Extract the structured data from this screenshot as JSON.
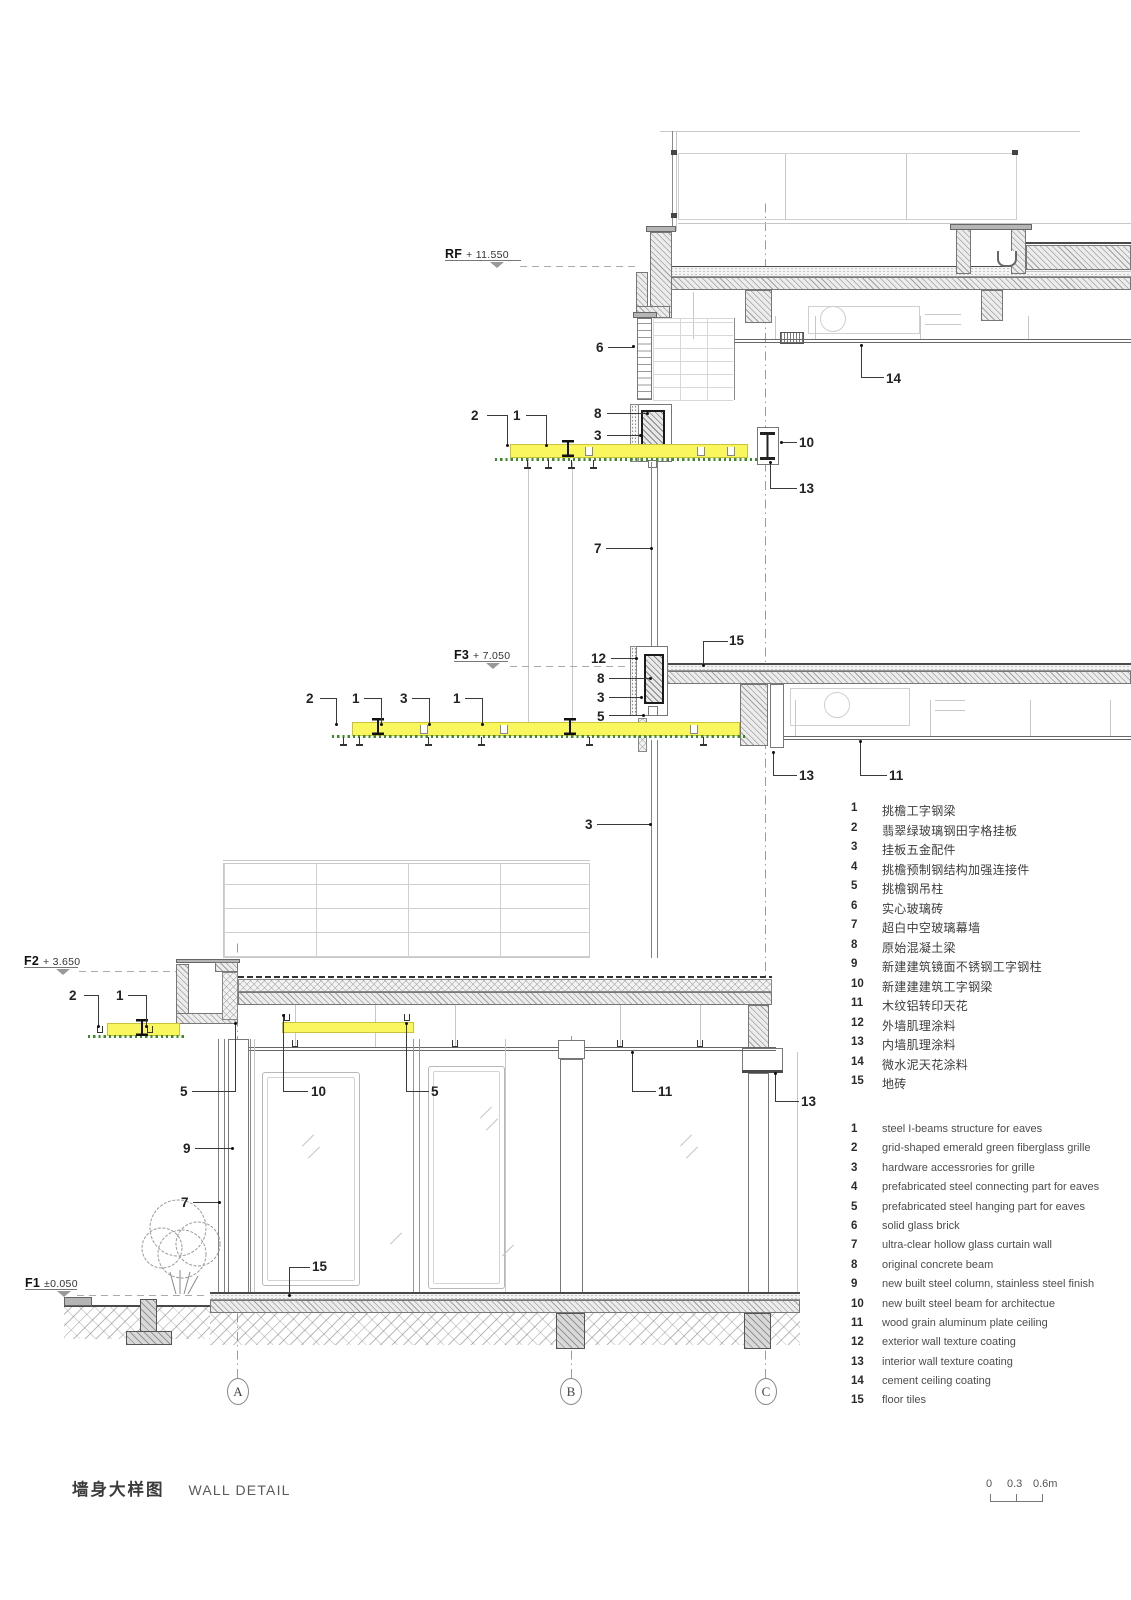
{
  "title": {
    "zh": "墙身大样图",
    "en": "WALL DETAIL"
  },
  "scale_bar": {
    "labels": [
      "0",
      "0.3",
      "0.6m"
    ]
  },
  "grid_axes": [
    "A",
    "B",
    "C"
  ],
  "levels": [
    {
      "label": "RF",
      "value": "+ 11.550"
    },
    {
      "label": "F3",
      "value": "+ 7.050"
    },
    {
      "label": "F2",
      "value": "+ 3.650"
    },
    {
      "label": "F1",
      "value": "±0.050"
    }
  ],
  "colors": {
    "eave_highlight": "#faf75e",
    "grille_green": "#3f8a28"
  },
  "legend_zh": {
    "items": [
      {
        "no": "1",
        "text": "挑檐工字钢梁"
      },
      {
        "no": "2",
        "text": "翡翠绿玻璃钢田字格挂板"
      },
      {
        "no": "3",
        "text": "挂板五金配件"
      },
      {
        "no": "4",
        "text": "挑檐预制钢结构加强连接件"
      },
      {
        "no": "5",
        "text": "挑檐钢吊柱"
      },
      {
        "no": "6",
        "text": "实心玻璃砖"
      },
      {
        "no": "7",
        "text": "超白中空玻璃幕墙"
      },
      {
        "no": "8",
        "text": "原始混凝土梁"
      },
      {
        "no": "9",
        "text": "新建建筑镜面不锈钢工字钢柱"
      },
      {
        "no": "10",
        "text": "新建建建筑工字钢梁"
      },
      {
        "no": "11",
        "text": "木纹铝转印天花"
      },
      {
        "no": "12",
        "text": "外墙肌理涂料"
      },
      {
        "no": "13",
        "text": "内墙肌理涂料"
      },
      {
        "no": "14",
        "text": "微水泥天花涂料"
      },
      {
        "no": "15",
        "text": "地砖"
      }
    ]
  },
  "legend_en": {
    "items": [
      {
        "no": "1",
        "text": "steel I-beams structure for eaves"
      },
      {
        "no": "2",
        "text": "grid-shaped emerald green fiberglass grille"
      },
      {
        "no": "3",
        "text": "hardware accessrories for grille"
      },
      {
        "no": "4",
        "text": "prefabricated steel connecting part for eaves"
      },
      {
        "no": "5",
        "text": "prefabricated steel hanging part for eaves"
      },
      {
        "no": "6",
        "text": "solid glass brick"
      },
      {
        "no": "7",
        "text": "ultra-clear hollow glass curtain wall"
      },
      {
        "no": "8",
        "text": "original concrete beam"
      },
      {
        "no": "9",
        "text": "new built steel column, stainless steel finish"
      },
      {
        "no": "10",
        "text": "new built steel beam for architectue"
      },
      {
        "no": "11",
        "text": "wood grain aluminum plate ceiling"
      },
      {
        "no": "12",
        "text": "exterior wall texture coating"
      },
      {
        "no": "13",
        "text": "interior wall texture coating"
      },
      {
        "no": "14",
        "text": "cement ceiling coating"
      },
      {
        "no": "15",
        "text": "floor tiles"
      }
    ]
  },
  "callouts": [
    {
      "label": "6",
      "x": 596,
      "y": 340,
      "segs": [
        [
          608,
          347,
          26,
          1
        ]
      ],
      "dot": [
        632,
        345
      ]
    },
    {
      "label": "14",
      "x": 886,
      "y": 371,
      "segs": [
        [
          861,
          345,
          1,
          33
        ],
        [
          862,
          377,
          22,
          1
        ]
      ],
      "dot": [
        860,
        344
      ]
    },
    {
      "label": "2",
      "x": 471,
      "y": 408,
      "segs": [
        [
          487,
          415,
          21,
          1
        ],
        [
          507,
          415,
          1,
          31
        ]
      ],
      "dot": [
        506,
        444
      ]
    },
    {
      "label": "1",
      "x": 513,
      "y": 408,
      "segs": [
        [
          526,
          415,
          21,
          1
        ],
        [
          546,
          415,
          1,
          31
        ]
      ],
      "dot": [
        545,
        444
      ]
    },
    {
      "label": "8",
      "x": 594,
      "y": 406,
      "segs": [
        [
          607,
          413,
          40,
          1
        ]
      ],
      "dot": [
        646,
        412
      ]
    },
    {
      "label": "3",
      "x": 594,
      "y": 428,
      "segs": [
        [
          607,
          435,
          33,
          1
        ]
      ],
      "dot": [
        639,
        434
      ]
    },
    {
      "label": "10",
      "x": 799,
      "y": 435,
      "segs": [
        [
          781,
          442,
          16,
          1
        ]
      ],
      "dot": [
        780,
        441
      ]
    },
    {
      "label": "13",
      "x": 799,
      "y": 481,
      "segs": [
        [
          770,
          462,
          1,
          27
        ],
        [
          770,
          488,
          27,
          1
        ]
      ],
      "dot": [
        769,
        461
      ]
    },
    {
      "label": "7",
      "x": 594,
      "y": 541,
      "segs": [
        [
          606,
          548,
          45,
          1
        ]
      ],
      "dot": [
        650,
        547
      ]
    },
    {
      "label": "15",
      "x": 729,
      "y": 633,
      "segs": [
        [
          703,
          641,
          25,
          1
        ],
        [
          703,
          641,
          1,
          25
        ]
      ],
      "dot": [
        702,
        664
      ]
    },
    {
      "label": "12",
      "x": 591,
      "y": 651,
      "segs": [
        [
          611,
          658,
          25,
          1
        ]
      ],
      "dot": [
        635,
        657
      ]
    },
    {
      "label": "8",
      "x": 597,
      "y": 671,
      "segs": [
        [
          609,
          678,
          41,
          1
        ]
      ],
      "dot": [
        649,
        677
      ]
    },
    {
      "label": "3",
      "x": 597,
      "y": 690,
      "segs": [
        [
          609,
          697,
          32,
          1
        ]
      ],
      "dot": [
        640,
        696
      ]
    },
    {
      "label": "5",
      "x": 597,
      "y": 709,
      "segs": [
        [
          609,
          715,
          34,
          1
        ]
      ],
      "dot": [
        642,
        714
      ]
    },
    {
      "label": "2",
      "x": 306,
      "y": 691,
      "segs": [
        [
          320,
          698,
          17,
          1
        ],
        [
          336,
          698,
          1,
          27
        ]
      ],
      "dot": [
        335,
        723
      ]
    },
    {
      "label": "1",
      "x": 352,
      "y": 691,
      "segs": [
        [
          364,
          698,
          18,
          1
        ],
        [
          381,
          698,
          1,
          27
        ]
      ],
      "dot": [
        380,
        723
      ]
    },
    {
      "label": "3",
      "x": 400,
      "y": 691,
      "segs": [
        [
          412,
          698,
          18,
          1
        ],
        [
          429,
          698,
          1,
          27
        ]
      ],
      "dot": [
        428,
        723
      ]
    },
    {
      "label": "1",
      "x": 453,
      "y": 691,
      "segs": [
        [
          465,
          698,
          18,
          1
        ],
        [
          482,
          698,
          1,
          27
        ]
      ],
      "dot": [
        481,
        723
      ]
    },
    {
      "label": "13",
      "x": 799,
      "y": 768,
      "segs": [
        [
          773,
          752,
          1,
          24
        ],
        [
          773,
          775,
          24,
          1
        ]
      ],
      "dot": [
        772,
        751
      ]
    },
    {
      "label": "11",
      "x": 889,
      "y": 768,
      "segs": [
        [
          860,
          741,
          1,
          35
        ],
        [
          860,
          775,
          27,
          1
        ]
      ],
      "dot": [
        859,
        740
      ]
    },
    {
      "label": "3",
      "x": 585,
      "y": 817,
      "segs": [
        [
          597,
          824,
          53,
          1
        ]
      ],
      "dot": [
        649,
        823
      ]
    },
    {
      "label": "2",
      "x": 69,
      "y": 988,
      "segs": [
        [
          84,
          995,
          15,
          1
        ],
        [
          98,
          995,
          1,
          31
        ]
      ],
      "dot": [
        97,
        1025
      ]
    },
    {
      "label": "1",
      "x": 116,
      "y": 988,
      "segs": [
        [
          128,
          995,
          19,
          1
        ],
        [
          146,
          995,
          1,
          31
        ]
      ],
      "dot": [
        145,
        1025
      ]
    },
    {
      "label": "5",
      "x": 180,
      "y": 1084,
      "segs": [
        [
          192,
          1091,
          44,
          1
        ],
        [
          235,
          1024,
          1,
          68
        ]
      ],
      "dot": [
        234,
        1022
      ]
    },
    {
      "label": "10",
      "x": 311,
      "y": 1084,
      "segs": [
        [
          283,
          1091,
          25,
          1
        ],
        [
          283,
          1016,
          1,
          76
        ]
      ],
      "dot": [
        282,
        1014
      ]
    },
    {
      "label": "5",
      "x": 431,
      "y": 1084,
      "segs": [
        [
          407,
          1091,
          22,
          1
        ],
        [
          406,
          1024,
          1,
          68
        ]
      ],
      "dot": [
        405,
        1022
      ]
    },
    {
      "label": "11",
      "x": 658,
      "y": 1084,
      "segs": [
        [
          633,
          1091,
          23,
          1
        ],
        [
          632,
          1053,
          1,
          39
        ]
      ],
      "dot": [
        631,
        1051
      ]
    },
    {
      "label": "13",
      "x": 801,
      "y": 1094,
      "segs": [
        [
          776,
          1101,
          23,
          1
        ],
        [
          775,
          1074,
          1,
          28
        ]
      ],
      "dot": [
        774,
        1072
      ]
    },
    {
      "label": "9",
      "x": 183,
      "y": 1141,
      "segs": [
        [
          195,
          1148,
          37,
          1
        ]
      ],
      "dot": [
        231,
        1147
      ]
    },
    {
      "label": "7",
      "x": 181,
      "y": 1195,
      "segs": [
        [
          193,
          1202,
          26,
          1
        ]
      ],
      "dot": [
        218,
        1201
      ]
    },
    {
      "label": "15",
      "x": 312,
      "y": 1259,
      "segs": [
        [
          289,
          1267,
          21,
          1
        ],
        [
          289,
          1267,
          1,
          28
        ]
      ],
      "dot": [
        288,
        1294
      ]
    }
  ]
}
